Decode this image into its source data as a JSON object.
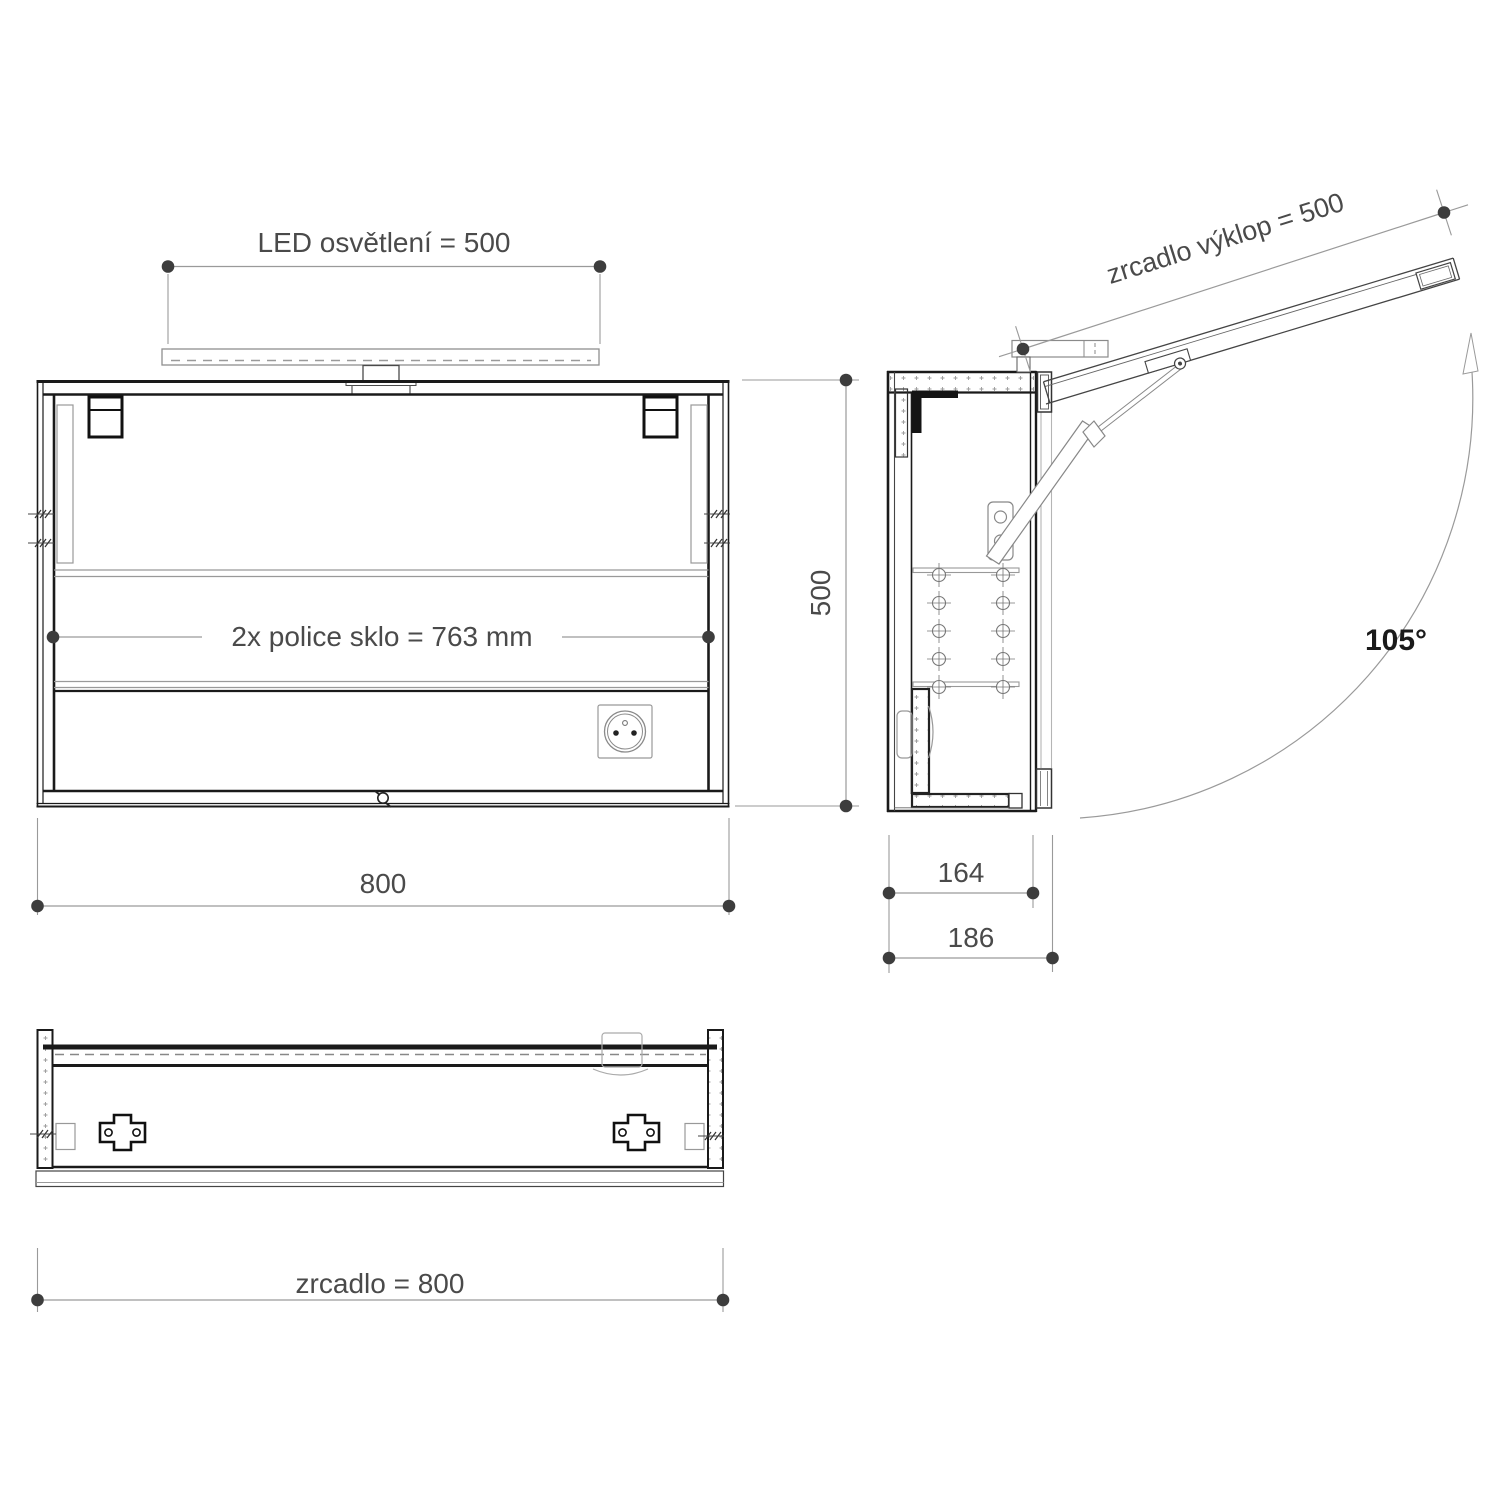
{
  "drawing": {
    "type": "technical-drawing",
    "subject": "mirror cabinet with LED light, three orthographic views",
    "front_view": {
      "led_dimension": "LED osvětlení = 500",
      "shelf_dimension": "2x  police sklo = 763 mm",
      "width_dimension": "800",
      "height_dimension": "500"
    },
    "side_view": {
      "flap_dimension": "zrcadlo výklop = 500",
      "opening_angle": "105°",
      "inner_depth_dimension": "164",
      "outer_depth_dimension": "186"
    },
    "bottom_view": {
      "mirror_width_dimension": "zrcadlo = 800"
    },
    "colors": {
      "structure_line": "#1a1a1a",
      "dimension_line": "#9a9a9a",
      "dimension_dot": "#3d3d3d",
      "text": "#4a4a4a",
      "hatch": "#999999",
      "phantom_line": "#b5b5b5"
    }
  }
}
